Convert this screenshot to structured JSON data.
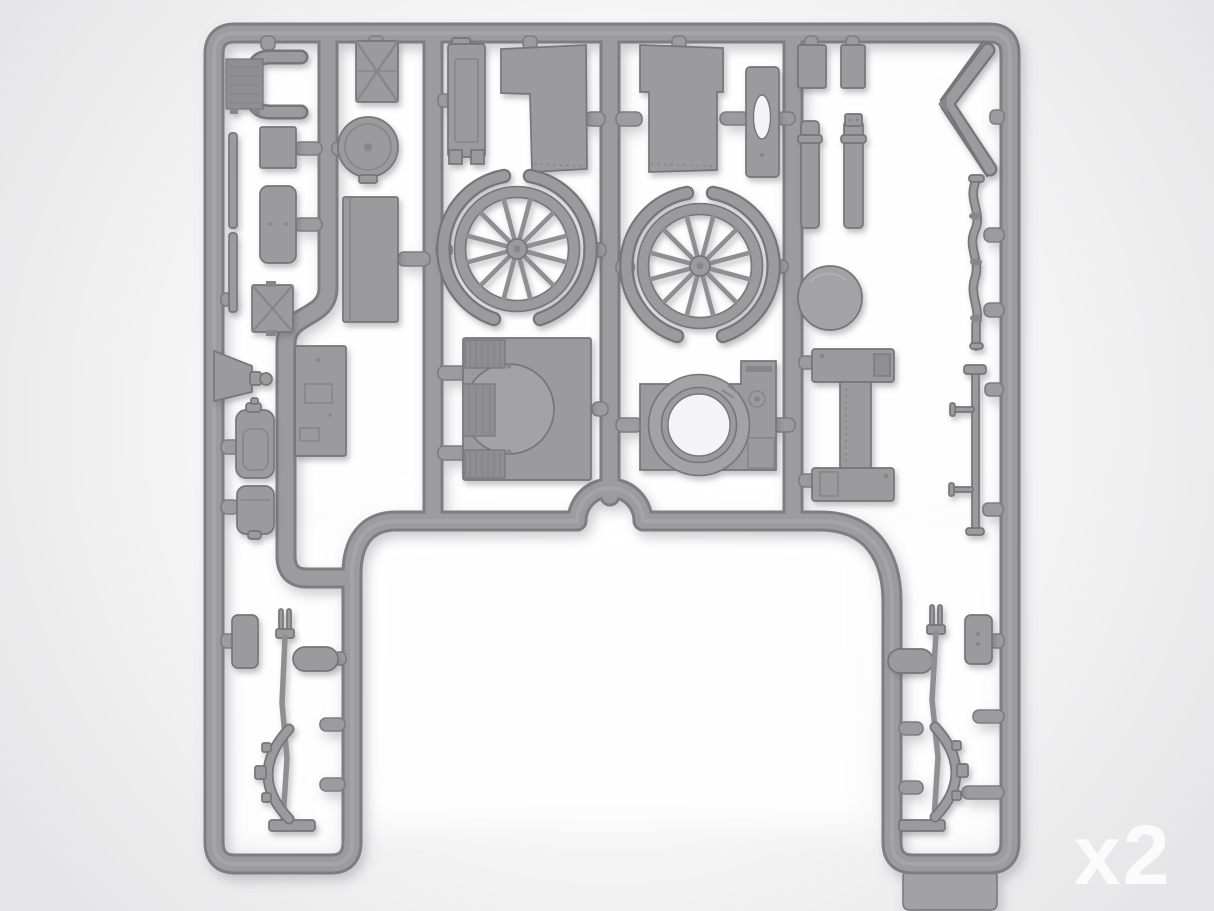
{
  "scene": {
    "subject": "Injection-molded gray polystyrene model kit sprue, top view on light backdrop",
    "quantity_label": "x2"
  },
  "colors": {
    "background_center": "#ffffff",
    "background_edge": "#e6e6e8",
    "sprue_body": "#9c9c9e",
    "sprue_edge": "#7e7e81",
    "part_fill": "#9b9b9d",
    "part_fill2": "#a3a3a5",
    "part_edge": "#767679",
    "part_detail": "#87878a",
    "part_rib": "#8f8f92",
    "hole_fill": "#f4f4f6",
    "tab_fill": "#a2a2a4",
    "watermark": "#ffffff"
  },
  "parts": [
    "radiator-and-bracket",
    "mounting-strip-a",
    "mounting-strip-b",
    "small-panel",
    "slat-bar",
    "cross-braced-panel-small",
    "horn-funnel",
    "muffler-canister",
    "fuel-can",
    "cross-braced-panel",
    "round-hatch-lid",
    "floor-panel",
    "firewall-panel",
    "radiator-shell",
    "body-side-panel-left",
    "spoked-wheel-left",
    "wheel-fender-arcs-left",
    "engine-fan-housing",
    "body-side-panel-right",
    "door-panel",
    "spoked-wheel-right",
    "wheel-fender-arcs-right",
    "turret-ring-mount",
    "chassis-beam",
    "small-block-a",
    "small-block-b",
    "exhaust-tube-a",
    "exhaust-tube-b",
    "tank-end-disc",
    "windshield-frame-folded",
    "front-axle-rod",
    "drive-shaft-with-pins",
    "seat-pad-left",
    "grab-handle-left",
    "steering-lever-left",
    "leaf-spring-left",
    "grab-handle-right",
    "seat-pad-right",
    "steering-lever-right",
    "leaf-spring-right",
    "sprue-gate-tab"
  ]
}
